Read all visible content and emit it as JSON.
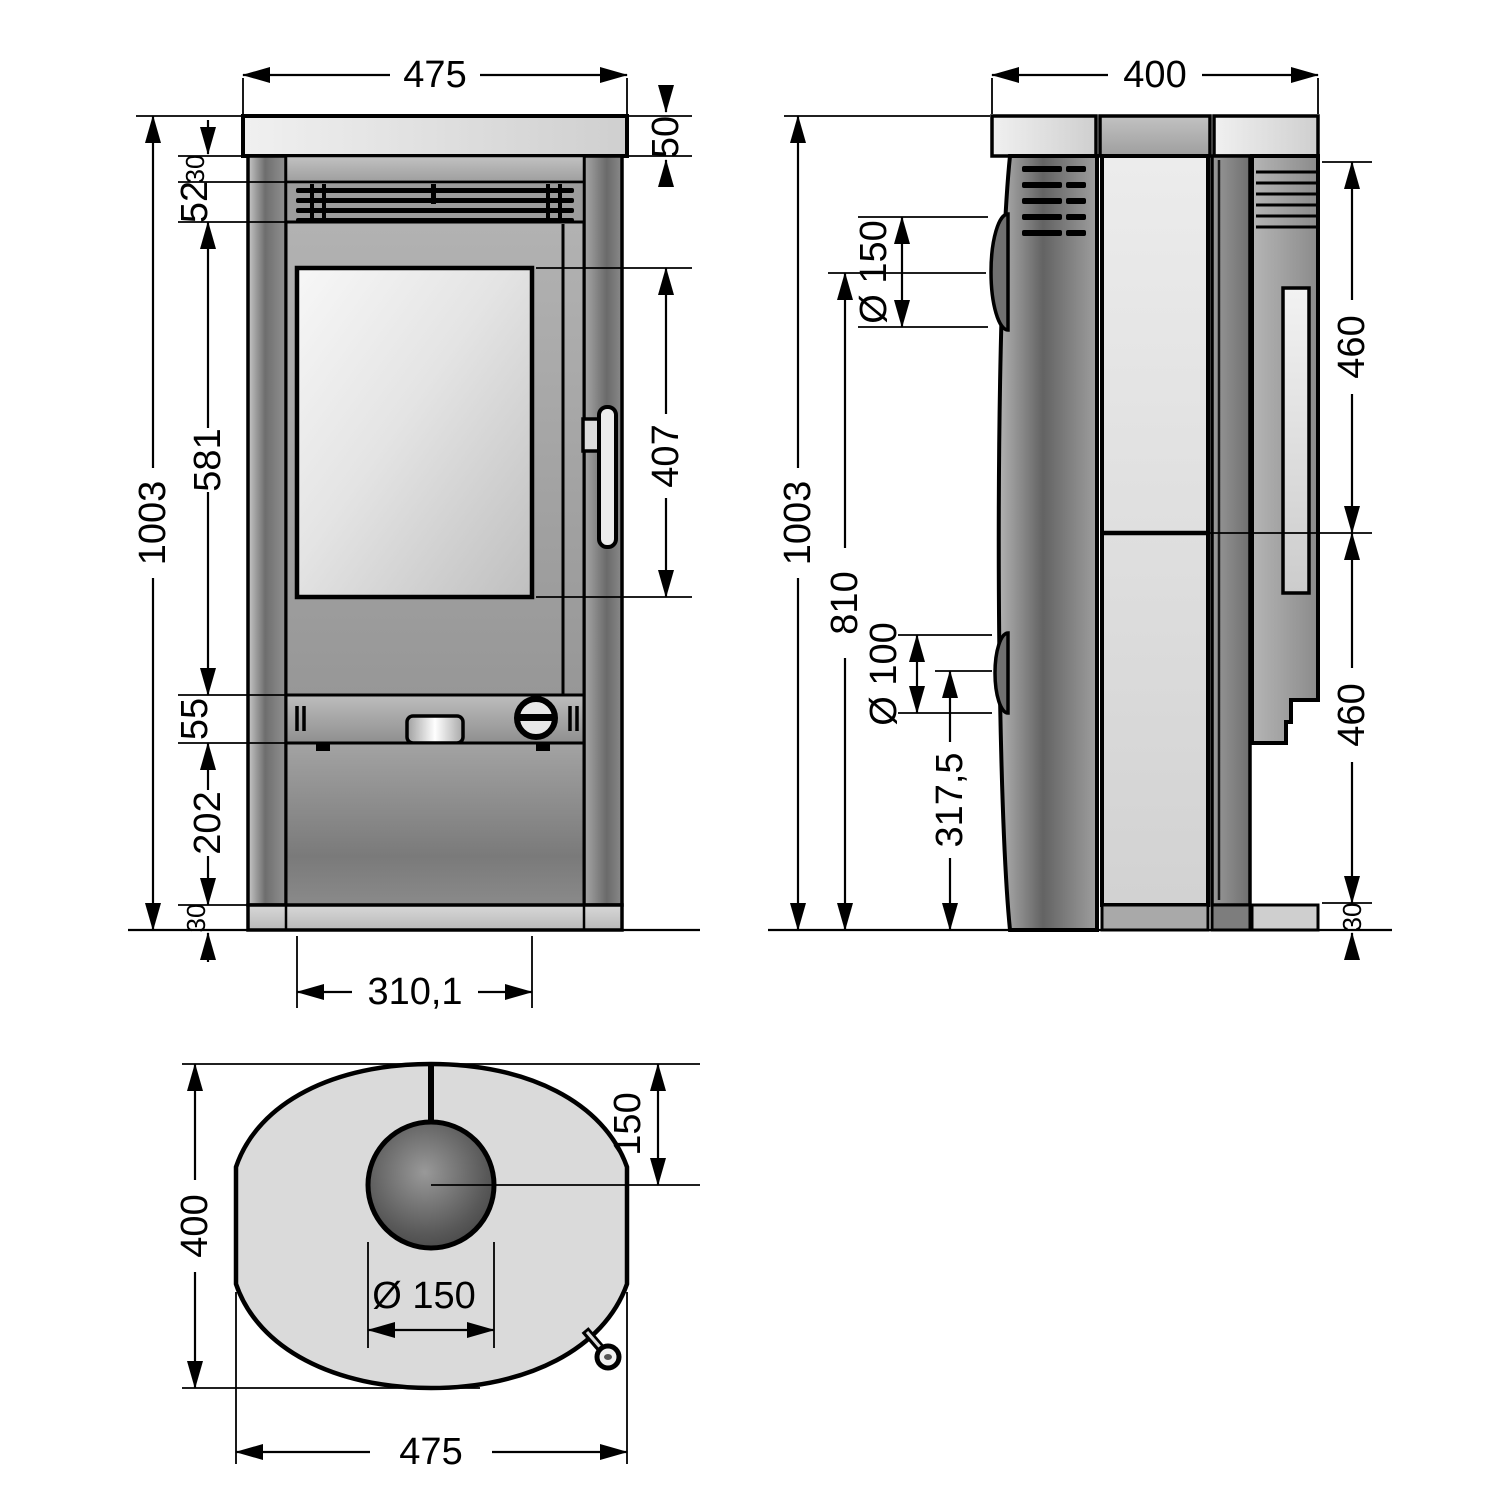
{
  "title": "stove-dimension-drawing",
  "front": {
    "dims": {
      "width_top": "475",
      "plate_height": "50",
      "top_strip": "30",
      "vent": "52",
      "door_area": "581",
      "band": "55",
      "lower_panel": "202",
      "base": "30",
      "total_height": "1003",
      "glass_height": "407",
      "door_width": "310,1"
    }
  },
  "side": {
    "dims": {
      "depth": "400",
      "total_height": "1003",
      "flue_height": "810",
      "flue_diameter": "Ø 150",
      "outlet_diameter": "Ø 100",
      "outlet_height": "317,5",
      "front_upper": "460",
      "front_lower": "460",
      "base": "30"
    }
  },
  "top": {
    "dims": {
      "depth": "400",
      "flue_offset": "150",
      "flue_diameter": "Ø 150",
      "width": "475"
    }
  },
  "colors": {
    "line": "#000000",
    "background": "#ffffff",
    "plate": "#e0e0e0",
    "body_gray": "#8c8c8c",
    "glass": "#e8e8e8",
    "stone": "#dfdfdf",
    "flue_dark": "#4f4f4f"
  }
}
